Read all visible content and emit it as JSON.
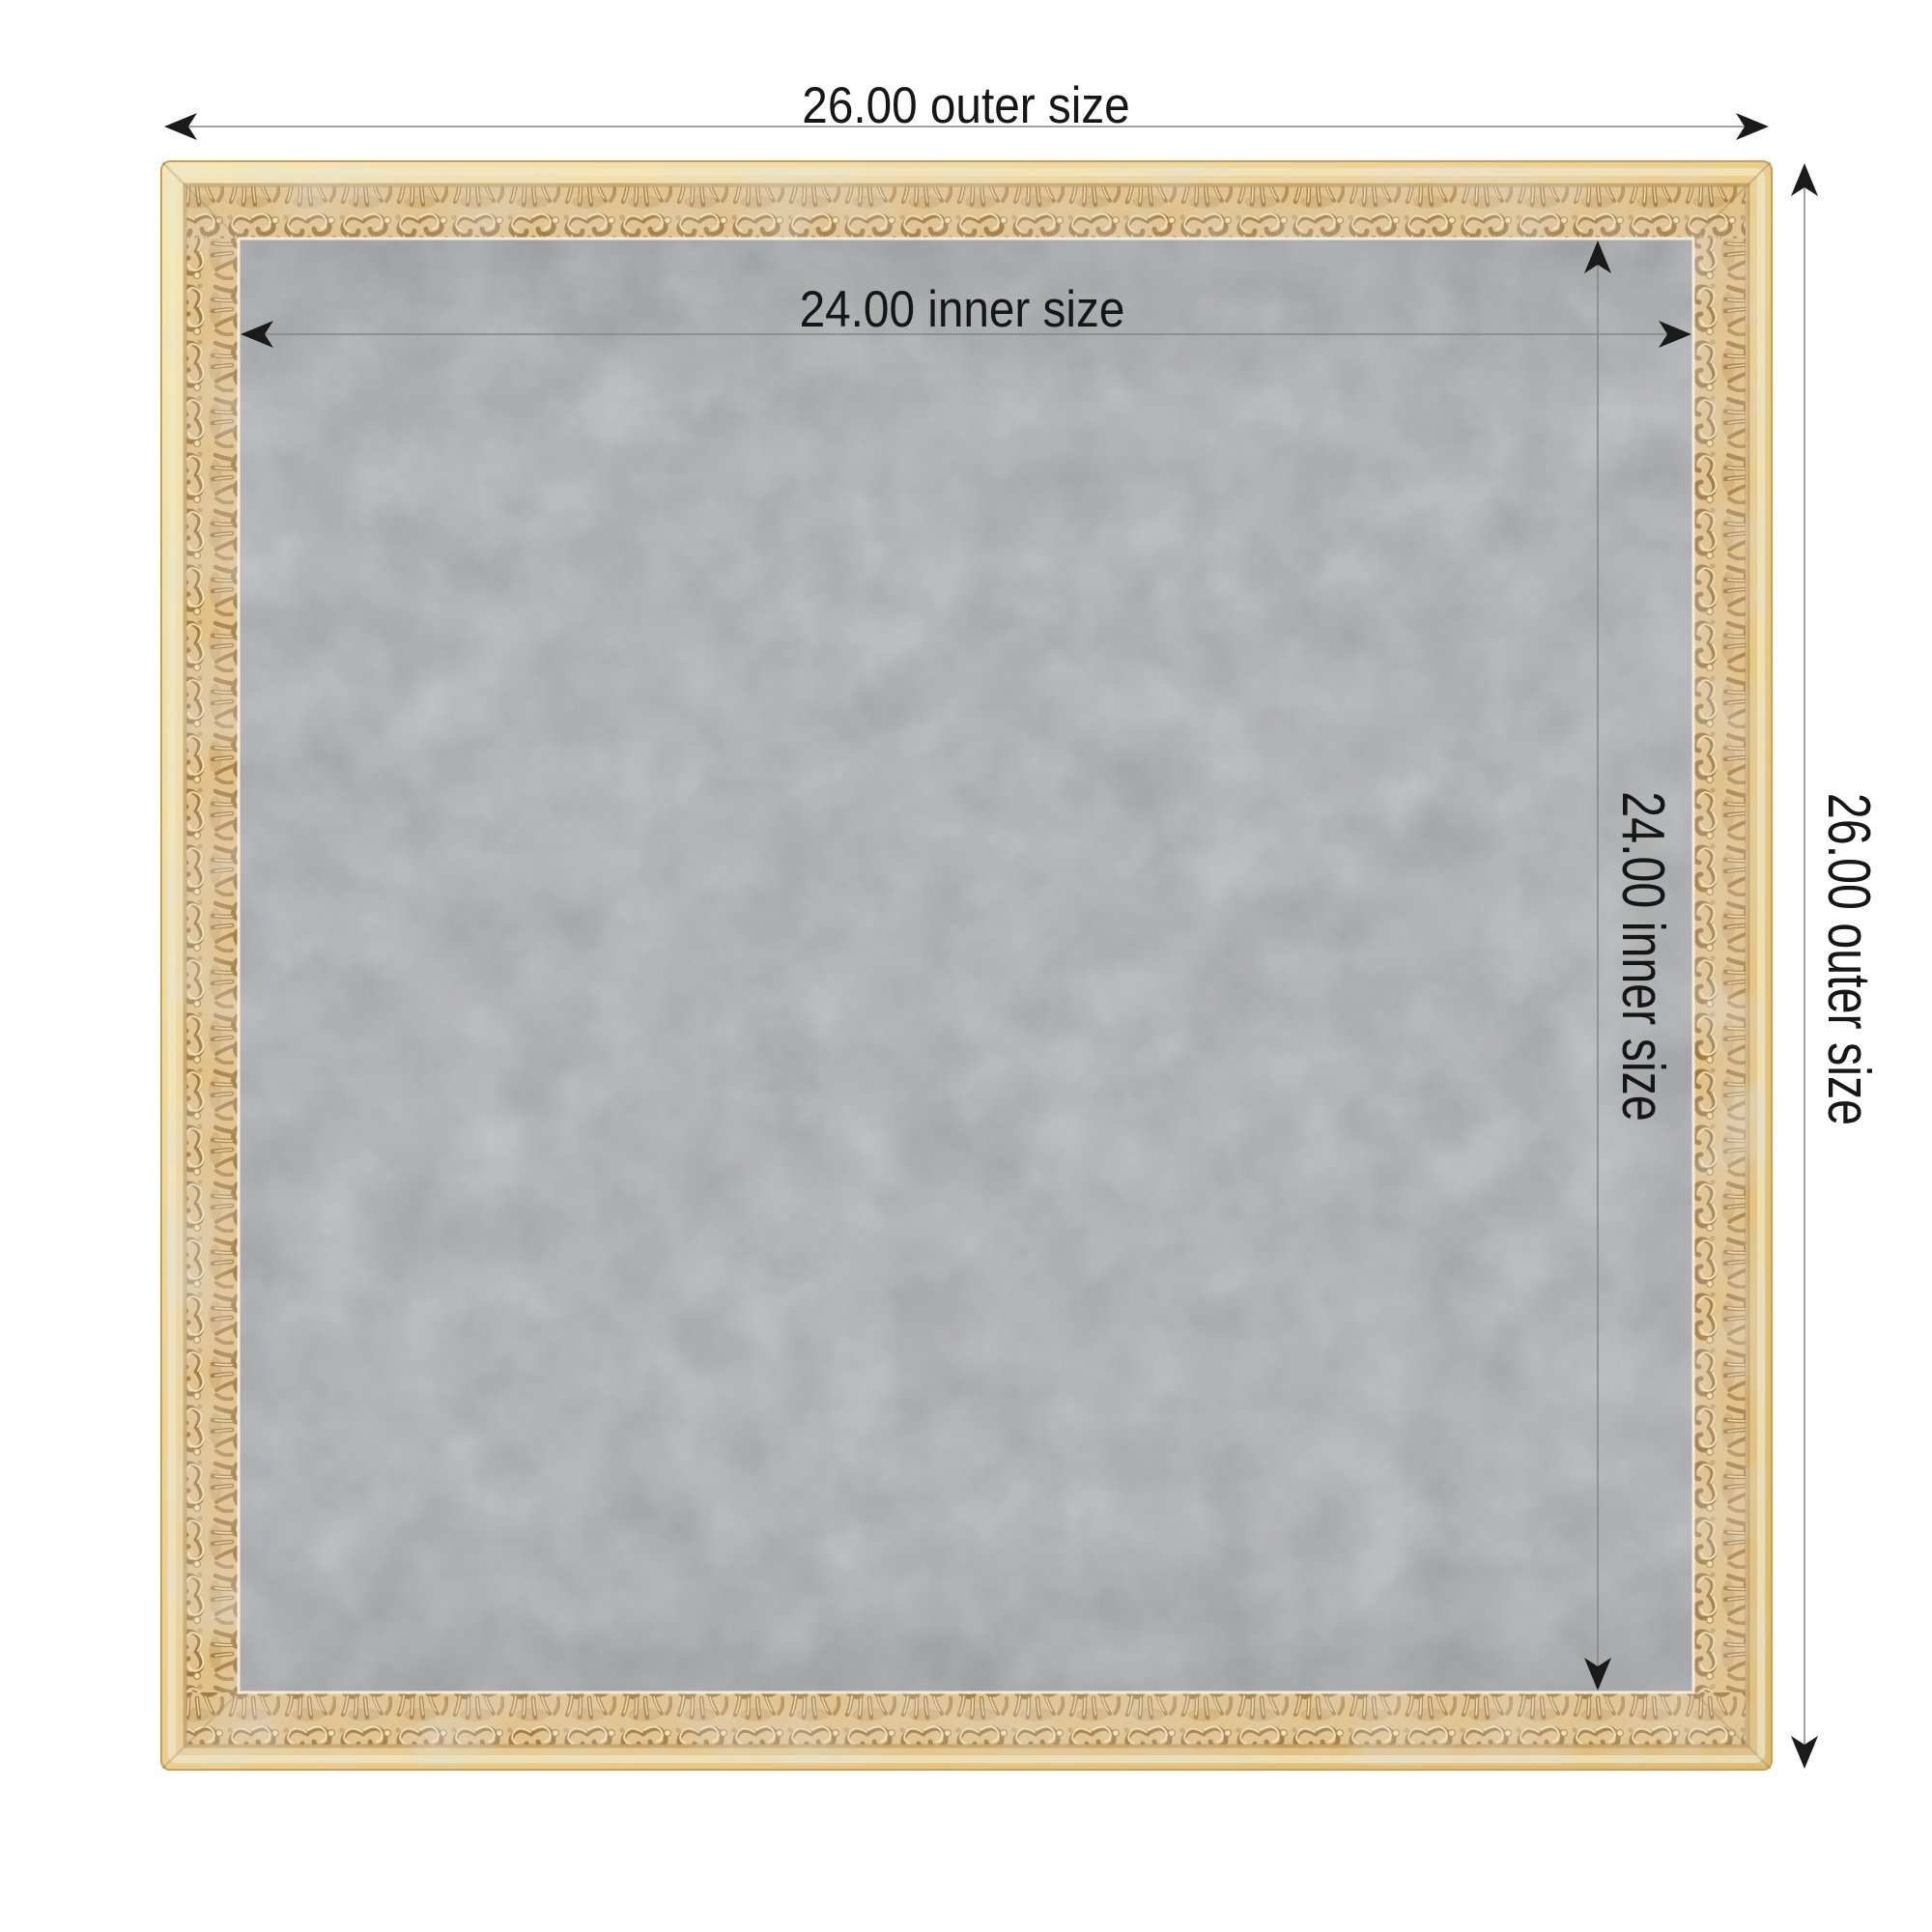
{
  "diagram": {
    "outer_width_label": "26.00 outer size",
    "outer_height_label": "26.00 outer size",
    "inner_width_label": "24.00 inner size",
    "inner_height_label": "24.00 inner size",
    "outer_size_value": "26.00",
    "inner_size_value": "24.00"
  },
  "colors": {
    "background": "#ffffff",
    "label_text": "#161616",
    "arrow": "#1a1a1a",
    "dimension_line_outer": "#a3a3a3",
    "dimension_line_inner": "#858585",
    "board_gray": "#a5a6a8",
    "frame_gold_base": "#e0bd7f",
    "frame_gold_highlight": "#f4e4b4",
    "frame_gold_shadow": "#a87e44",
    "frame_lip": "#ecd093"
  }
}
